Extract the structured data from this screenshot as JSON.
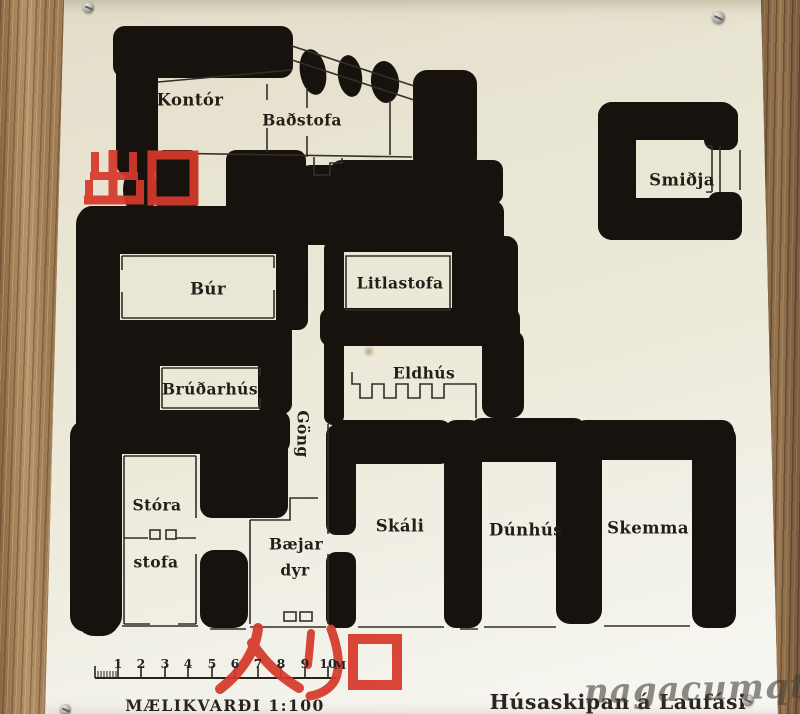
{
  "sign": {
    "title": "Húsaskipan á Laufási",
    "rooms": {
      "kontor": "Kontór",
      "badstofa": "Baðstofa",
      "smidja": "Smiðja",
      "bur": "Búr",
      "litlastofa": "Litlastofa",
      "brudarhus": "Brúðarhús",
      "eldhus": "Eldhús",
      "gong": "Göng",
      "stora_stofa_line1": "Stóra",
      "stora_stofa_line2": "stofa",
      "baejardyr_line1": "Bæjar",
      "baejardyr_line2": "dyr",
      "skali": "Skáli",
      "dunhus": "Dúnhús",
      "skemma": "Skemma"
    },
    "scale": {
      "label": "MÆLIKVARÐI  1:100",
      "numbers": [
        "1",
        "2",
        "3",
        "4",
        "5",
        "6",
        "7",
        "8",
        "9",
        "10"
      ],
      "unit": "M"
    }
  },
  "annotations": {
    "exit": "出口",
    "entrance": "入り口",
    "color": "#d5392a"
  },
  "watermark": {
    "text": "nagacumqtz"
  },
  "colors": {
    "wall_black": "#18120e",
    "sign_cream": "#ece8d8",
    "wood_brown": "#a8845c",
    "annotation_red": "#d5392a"
  }
}
